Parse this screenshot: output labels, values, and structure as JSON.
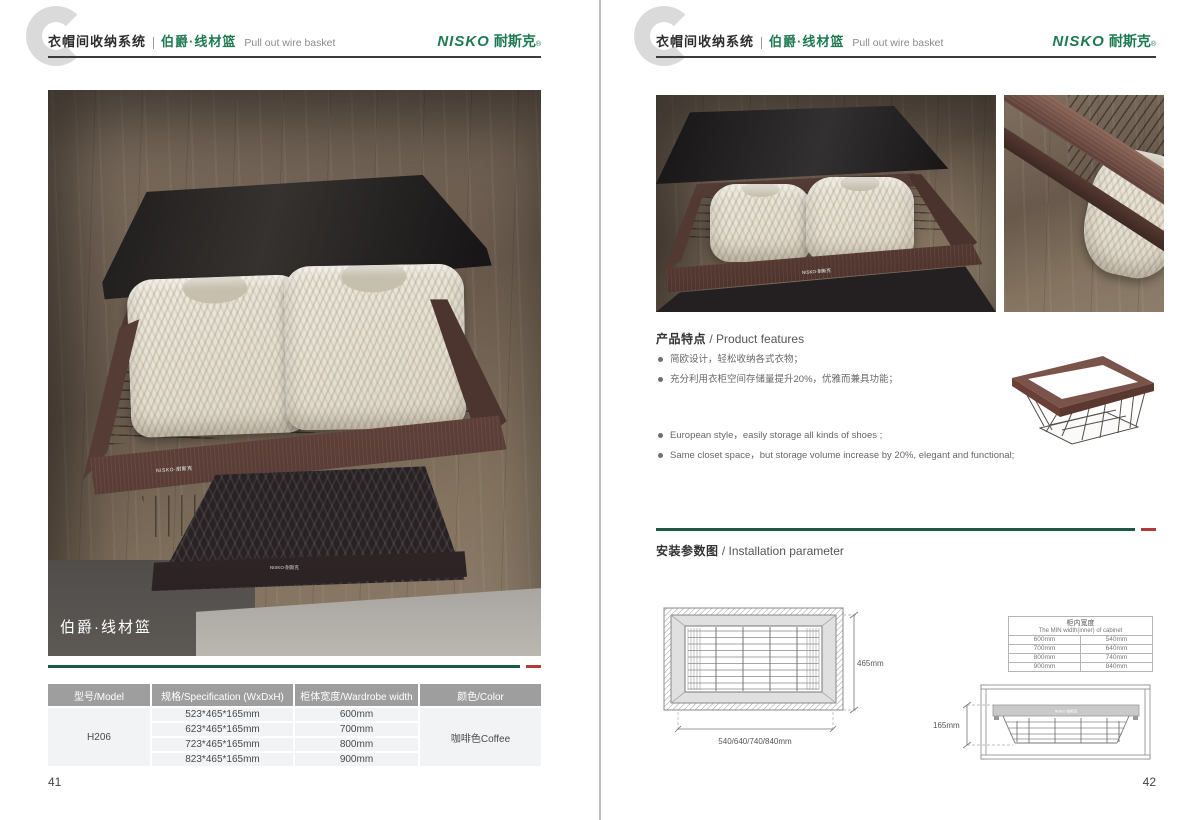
{
  "brand": {
    "name_latin": "NISKO",
    "name_cn": "耐斯克",
    "reg_mark": "®"
  },
  "header": {
    "system_cn": "衣帽间收纳系统",
    "product_cn": "伯爵·线材篮",
    "product_en": "Pull out wire basket"
  },
  "left_page": {
    "page_number": "41",
    "photo_caption": "伯爵·线材篮",
    "rail_logo": "NISKO·耐斯克",
    "spec_table": {
      "headers": [
        "型号/Model",
        "规格/Specification (WxDxH)",
        "柜体宽度/Wardrobe width",
        "颜色/Color"
      ],
      "model": "H206",
      "color": "咖啡色Coffee",
      "rows": [
        {
          "spec": "523*465*165mm",
          "width": "600mm"
        },
        {
          "spec": "623*465*165mm",
          "width": "700mm"
        },
        {
          "spec": "723*465*165mm",
          "width": "800mm"
        },
        {
          "spec": "823*465*165mm",
          "width": "900mm"
        }
      ]
    }
  },
  "right_page": {
    "page_number": "42",
    "features": {
      "title_cn": "产品特点",
      "title_en": "/ Product features",
      "bullets_cn": [
        "简欧设计，轻松收纳各式衣物；",
        "充分利用衣柜空间存储量提升20%，优雅而兼具功能；"
      ],
      "bullets_en": [
        "European style，easily storage all kinds of shoes ;",
        "Same closet space，but storage volume increase by 20%, elegant and functional;"
      ]
    },
    "installation": {
      "title_cn": "安装参数图",
      "title_en": "/ Installation parameter",
      "top_view": {
        "depth_label": "465mm",
        "width_label": "540/640/740/840mm"
      },
      "front_view": {
        "height_label": "165mm"
      },
      "width_table": {
        "title_cn": "柜内宽度",
        "title_en": "The MIN width(inner) of cabinet",
        "rows": [
          {
            "cabinet": "600mm",
            "inner": "540mm"
          },
          {
            "cabinet": "700mm",
            "inner": "640mm"
          },
          {
            "cabinet": "800mm",
            "inner": "740mm"
          },
          {
            "cabinet": "900mm",
            "inner": "840mm"
          }
        ]
      }
    }
  },
  "colors": {
    "brand_green": "#1f7a52",
    "accent_red": "#b23a37",
    "line_green": "#20583f"
  }
}
